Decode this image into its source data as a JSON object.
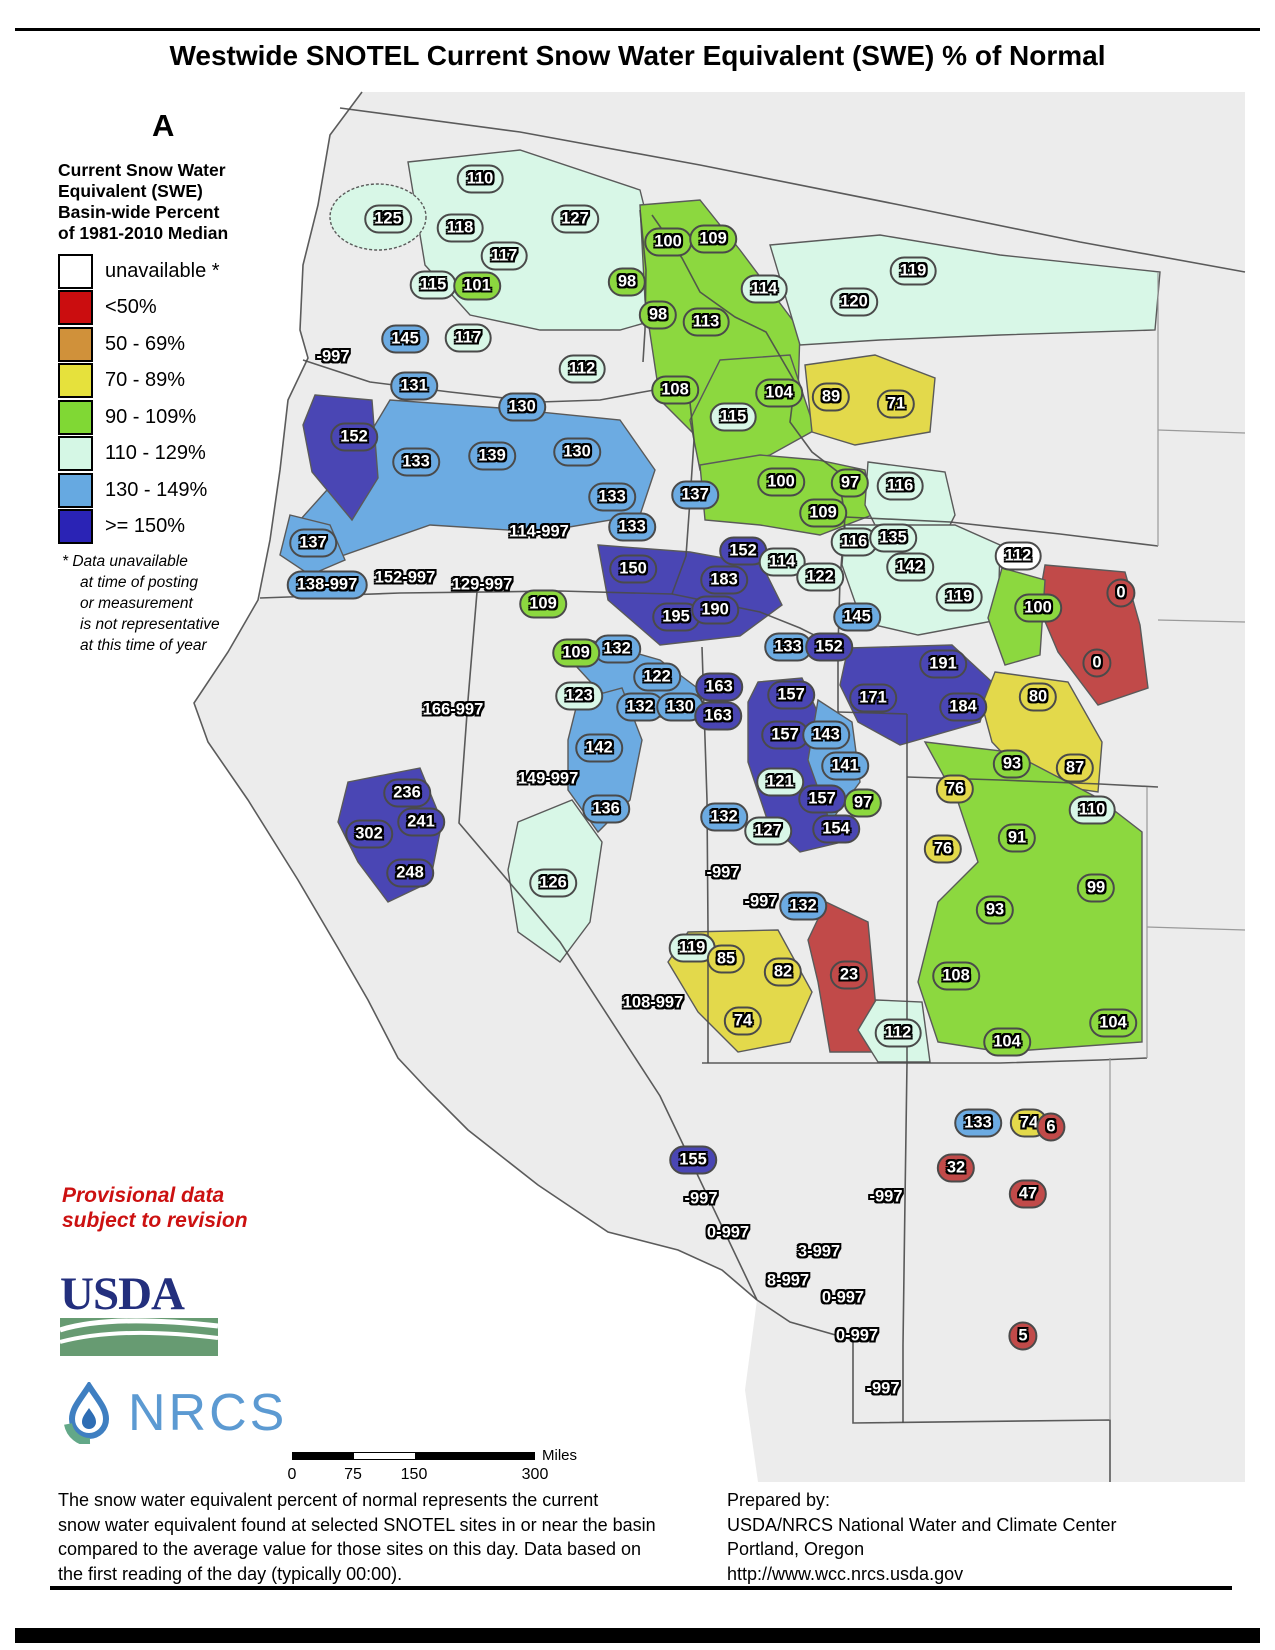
{
  "title": "Westwide SNOTEL Current Snow Water Equivalent (SWE) % of Normal",
  "date": "Apr 17, 2017",
  "legend": {
    "heading_lines": [
      "Current Snow Water",
      "Equivalent (SWE)",
      "Basin-wide Percent",
      "of 1981-2010 Median"
    ],
    "items": [
      {
        "label": "unavailable *",
        "color": "#ffffff"
      },
      {
        "label": "<50%",
        "color": "#cb0d0f"
      },
      {
        "label": "50 - 69%",
        "color": "#d0913a"
      },
      {
        "label": "70 - 89%",
        "color": "#e6e13c"
      },
      {
        "label": "90 - 109%",
        "color": "#80d834"
      },
      {
        "label": "110 - 129%",
        "color": "#d5f7e5"
      },
      {
        "label": "130 - 149%",
        "color": "#66a9e1"
      },
      {
        "label": ">= 150%",
        "color": "#2a23b5"
      }
    ],
    "footnote_lines": [
      "*   Data unavailable",
      "at time of posting",
      "or measurement",
      "is not representative",
      "at this time of year"
    ]
  },
  "provisional_lines": [
    "Provisional data",
    "subject to revision"
  ],
  "logos": {
    "usda": "USDA",
    "nrcs": "NRCS"
  },
  "scalebar": {
    "ticks": [
      "0",
      "75",
      "150",
      "300"
    ],
    "unit": "Miles"
  },
  "footer_left_lines": [
    "The snow water equivalent percent of normal represents the current",
    "snow water equivalent found at selected SNOTEL sites in or near the basin",
    "compared to the average value for those sites on this day. Data based on",
    "the first reading of the day (typically 00:00)."
  ],
  "footer_right_lines": [
    "Prepared by:",
    "USDA/NRCS National Water and Climate Center",
    "Portland, Oregon",
    "http://www.wcc.nrcs.usda.gov"
  ],
  "colors": {
    "red": "#c14a49",
    "orange": "#d0913a",
    "yellow": "#e3d94b",
    "green": "#8cd83f",
    "cyan": "#d8f7e7",
    "blue": "#6cabe2",
    "dkblue": "#4a46b4",
    "white": "#ffffff",
    "land": "#ececec",
    "ocean": "#ffffff",
    "border": "#4a4a4a"
  },
  "map": {
    "labels": [
      {
        "t": "125",
        "x": 388,
        "y": 219,
        "c": "cyan"
      },
      {
        "t": "110",
        "x": 480,
        "y": 179,
        "c": "cyan"
      },
      {
        "t": "118",
        "x": 460,
        "y": 228,
        "c": "cyan"
      },
      {
        "t": "127",
        "x": 575,
        "y": 219,
        "c": "cyan"
      },
      {
        "t": "117",
        "x": 504,
        "y": 256,
        "c": "cyan"
      },
      {
        "t": "115",
        "x": 433,
        "y": 285,
        "c": "cyan"
      },
      {
        "t": "101",
        "x": 477,
        "y": 286,
        "c": "green"
      },
      {
        "t": "117",
        "x": 468,
        "y": 338,
        "c": "cyan"
      },
      {
        "t": "145",
        "x": 405,
        "y": 339,
        "c": "blue"
      },
      {
        "t": "-997",
        "x": 333,
        "y": 357,
        "c": "none"
      },
      {
        "t": "112",
        "x": 582,
        "y": 369,
        "c": "cyan"
      },
      {
        "t": "131",
        "x": 414,
        "y": 386,
        "c": "blue"
      },
      {
        "t": "130",
        "x": 522,
        "y": 407,
        "c": "blue"
      },
      {
        "t": "100",
        "x": 668,
        "y": 242,
        "c": "green"
      },
      {
        "t": "109",
        "x": 713,
        "y": 239,
        "c": "green"
      },
      {
        "t": "98",
        "x": 627,
        "y": 282,
        "c": "green"
      },
      {
        "t": "114",
        "x": 764,
        "y": 289,
        "c": "cyan"
      },
      {
        "t": "119",
        "x": 913,
        "y": 271,
        "c": "cyan"
      },
      {
        "t": "120",
        "x": 854,
        "y": 302,
        "c": "cyan"
      },
      {
        "t": "98",
        "x": 658,
        "y": 315,
        "c": "green"
      },
      {
        "t": "113",
        "x": 706,
        "y": 322,
        "c": "green"
      },
      {
        "t": "108",
        "x": 675,
        "y": 390,
        "c": "green"
      },
      {
        "t": "104",
        "x": 779,
        "y": 393,
        "c": "green"
      },
      {
        "t": "89",
        "x": 831,
        "y": 397,
        "c": "yellow"
      },
      {
        "t": "71",
        "x": 896,
        "y": 404,
        "c": "yellow"
      },
      {
        "t": "115",
        "x": 733,
        "y": 417,
        "c": "cyan"
      },
      {
        "t": "152",
        "x": 354,
        "y": 437,
        "c": "dkblue"
      },
      {
        "t": "133",
        "x": 416,
        "y": 462,
        "c": "blue"
      },
      {
        "t": "139",
        "x": 492,
        "y": 456,
        "c": "blue"
      },
      {
        "t": "130",
        "x": 577,
        "y": 452,
        "c": "blue"
      },
      {
        "t": "137",
        "x": 695,
        "y": 495,
        "c": "blue"
      },
      {
        "t": "100",
        "x": 781,
        "y": 482,
        "c": "green"
      },
      {
        "t": "97",
        "x": 850,
        "y": 483,
        "c": "green"
      },
      {
        "t": "116",
        "x": 900,
        "y": 486,
        "c": "cyan"
      },
      {
        "t": "109",
        "x": 823,
        "y": 513,
        "c": "green"
      },
      {
        "t": "133",
        "x": 612,
        "y": 497,
        "c": "blue"
      },
      {
        "t": "133",
        "x": 632,
        "y": 527,
        "c": "blue"
      },
      {
        "t": "114-997",
        "x": 539,
        "y": 532,
        "c": "none"
      },
      {
        "t": "137",
        "x": 313,
        "y": 543,
        "c": "blue"
      },
      {
        "t": "150",
        "x": 633,
        "y": 569,
        "c": "dkblue"
      },
      {
        "t": "138-997",
        "x": 327,
        "y": 585,
        "c": "blue"
      },
      {
        "t": "152-997",
        "x": 405,
        "y": 578,
        "c": "none"
      },
      {
        "t": "129-997",
        "x": 482,
        "y": 585,
        "c": "none"
      },
      {
        "t": "109",
        "x": 543,
        "y": 604,
        "c": "green"
      },
      {
        "t": "152",
        "x": 743,
        "y": 551,
        "c": "dkblue"
      },
      {
        "t": "114",
        "x": 782,
        "y": 562,
        "c": "cyan"
      },
      {
        "t": "122",
        "x": 820,
        "y": 577,
        "c": "cyan"
      },
      {
        "t": "183",
        "x": 724,
        "y": 580,
        "c": "dkblue"
      },
      {
        "t": "116",
        "x": 854,
        "y": 542,
        "c": "cyan"
      },
      {
        "t": "135",
        "x": 893,
        "y": 538,
        "c": "cyan"
      },
      {
        "t": "142",
        "x": 910,
        "y": 567,
        "c": "cyan"
      },
      {
        "t": "119",
        "x": 959,
        "y": 597,
        "c": "cyan"
      },
      {
        "t": "112",
        "x": 1018,
        "y": 556,
        "c": "white"
      },
      {
        "t": "195",
        "x": 676,
        "y": 617,
        "c": "dkblue"
      },
      {
        "t": "190",
        "x": 715,
        "y": 610,
        "c": "dkblue"
      },
      {
        "t": "145",
        "x": 857,
        "y": 617,
        "c": "blue"
      },
      {
        "t": "133",
        "x": 788,
        "y": 647,
        "c": "blue"
      },
      {
        "t": "152",
        "x": 829,
        "y": 647,
        "c": "dkblue"
      },
      {
        "t": "132",
        "x": 617,
        "y": 649,
        "c": "blue"
      },
      {
        "t": "100",
        "x": 1038,
        "y": 608,
        "c": "green"
      },
      {
        "t": "0",
        "x": 1121,
        "y": 593,
        "c": "red"
      },
      {
        "t": "0",
        "x": 1097,
        "y": 663,
        "c": "red"
      },
      {
        "t": "191",
        "x": 943,
        "y": 664,
        "c": "dkblue"
      },
      {
        "t": "171",
        "x": 873,
        "y": 698,
        "c": "dkblue"
      },
      {
        "t": "184",
        "x": 963,
        "y": 707,
        "c": "dkblue"
      },
      {
        "t": "80",
        "x": 1038,
        "y": 697,
        "c": "yellow"
      },
      {
        "t": "93",
        "x": 1012,
        "y": 764,
        "c": "green"
      },
      {
        "t": "87",
        "x": 1075,
        "y": 768,
        "c": "yellow"
      },
      {
        "t": "109",
        "x": 576,
        "y": 653,
        "c": "green"
      },
      {
        "t": "122",
        "x": 657,
        "y": 677,
        "c": "blue"
      },
      {
        "t": "123",
        "x": 579,
        "y": 696,
        "c": "cyan"
      },
      {
        "t": "132",
        "x": 640,
        "y": 707,
        "c": "blue"
      },
      {
        "t": "130",
        "x": 680,
        "y": 707,
        "c": "blue"
      },
      {
        "t": "163",
        "x": 719,
        "y": 687,
        "c": "dkblue"
      },
      {
        "t": "163",
        "x": 718,
        "y": 716,
        "c": "dkblue"
      },
      {
        "t": "166-997",
        "x": 453,
        "y": 710,
        "c": "none"
      },
      {
        "t": "142",
        "x": 599,
        "y": 748,
        "c": "blue"
      },
      {
        "t": "149-997",
        "x": 548,
        "y": 779,
        "c": "none"
      },
      {
        "t": "136",
        "x": 606,
        "y": 809,
        "c": "blue"
      },
      {
        "t": "236",
        "x": 407,
        "y": 793,
        "c": "dkblue"
      },
      {
        "t": "241",
        "x": 421,
        "y": 822,
        "c": "dkblue"
      },
      {
        "t": "302",
        "x": 369,
        "y": 834,
        "c": "dkblue"
      },
      {
        "t": "248",
        "x": 410,
        "y": 873,
        "c": "dkblue"
      },
      {
        "t": "126",
        "x": 553,
        "y": 883,
        "c": "cyan"
      },
      {
        "t": "132",
        "x": 724,
        "y": 817,
        "c": "blue"
      },
      {
        "t": "-997",
        "x": 723,
        "y": 873,
        "c": "none"
      },
      {
        "t": "157",
        "x": 791,
        "y": 695,
        "c": "dkblue"
      },
      {
        "t": "157",
        "x": 785,
        "y": 735,
        "c": "dkblue"
      },
      {
        "t": "143",
        "x": 826,
        "y": 735,
        "c": "blue"
      },
      {
        "t": "141",
        "x": 845,
        "y": 766,
        "c": "blue"
      },
      {
        "t": "121",
        "x": 780,
        "y": 782,
        "c": "cyan"
      },
      {
        "t": "157",
        "x": 822,
        "y": 799,
        "c": "dkblue"
      },
      {
        "t": "97",
        "x": 863,
        "y": 803,
        "c": "green"
      },
      {
        "t": "76",
        "x": 955,
        "y": 789,
        "c": "yellow"
      },
      {
        "t": "110",
        "x": 1092,
        "y": 810,
        "c": "cyan"
      },
      {
        "t": "127",
        "x": 768,
        "y": 831,
        "c": "cyan"
      },
      {
        "t": "154",
        "x": 836,
        "y": 829,
        "c": "dkblue"
      },
      {
        "t": "76",
        "x": 943,
        "y": 849,
        "c": "yellow"
      },
      {
        "t": "91",
        "x": 1017,
        "y": 838,
        "c": "green"
      },
      {
        "t": "99",
        "x": 1096,
        "y": 888,
        "c": "green"
      },
      {
        "t": "93",
        "x": 995,
        "y": 910,
        "c": "green"
      },
      {
        "t": "23",
        "x": 849,
        "y": 975,
        "c": "red"
      },
      {
        "t": "108",
        "x": 956,
        "y": 976,
        "c": "green"
      },
      {
        "t": "112",
        "x": 898,
        "y": 1033,
        "c": "cyan"
      },
      {
        "t": "104",
        "x": 1007,
        "y": 1042,
        "c": "green"
      },
      {
        "t": "104",
        "x": 1113,
        "y": 1023,
        "c": "green"
      },
      {
        "t": "133",
        "x": 978,
        "y": 1123,
        "c": "blue"
      },
      {
        "t": "74",
        "x": 1029,
        "y": 1123,
        "c": "yellow"
      },
      {
        "t": "6",
        "x": 1051,
        "y": 1127,
        "c": "red"
      },
      {
        "t": "-997",
        "x": 761,
        "y": 902,
        "c": "none"
      },
      {
        "t": "132",
        "x": 803,
        "y": 906,
        "c": "blue"
      },
      {
        "t": "119",
        "x": 692,
        "y": 948,
        "c": "cyan"
      },
      {
        "t": "85",
        "x": 726,
        "y": 959,
        "c": "yellow"
      },
      {
        "t": "82",
        "x": 783,
        "y": 972,
        "c": "yellow"
      },
      {
        "t": "108-997",
        "x": 653,
        "y": 1003,
        "c": "none"
      },
      {
        "t": "74",
        "x": 743,
        "y": 1021,
        "c": "yellow"
      },
      {
        "t": "155",
        "x": 693,
        "y": 1160,
        "c": "dkblue"
      },
      {
        "t": "32",
        "x": 956,
        "y": 1168,
        "c": "red"
      },
      {
        "t": "-997",
        "x": 701,
        "y": 1199,
        "c": "none"
      },
      {
        "t": "-997",
        "x": 886,
        "y": 1197,
        "c": "none"
      },
      {
        "t": "47",
        "x": 1028,
        "y": 1194,
        "c": "red"
      },
      {
        "t": "0-997",
        "x": 728,
        "y": 1233,
        "c": "none"
      },
      {
        "t": "3-997",
        "x": 819,
        "y": 1252,
        "c": "none"
      },
      {
        "t": "8-997",
        "x": 788,
        "y": 1281,
        "c": "none"
      },
      {
        "t": "0-997",
        "x": 843,
        "y": 1298,
        "c": "none"
      },
      {
        "t": "0-997",
        "x": 857,
        "y": 1336,
        "c": "none"
      },
      {
        "t": "5",
        "x": 1023,
        "y": 1336,
        "c": "red"
      },
      {
        "t": "-997",
        "x": 883,
        "y": 1389,
        "c": "none"
      }
    ]
  }
}
